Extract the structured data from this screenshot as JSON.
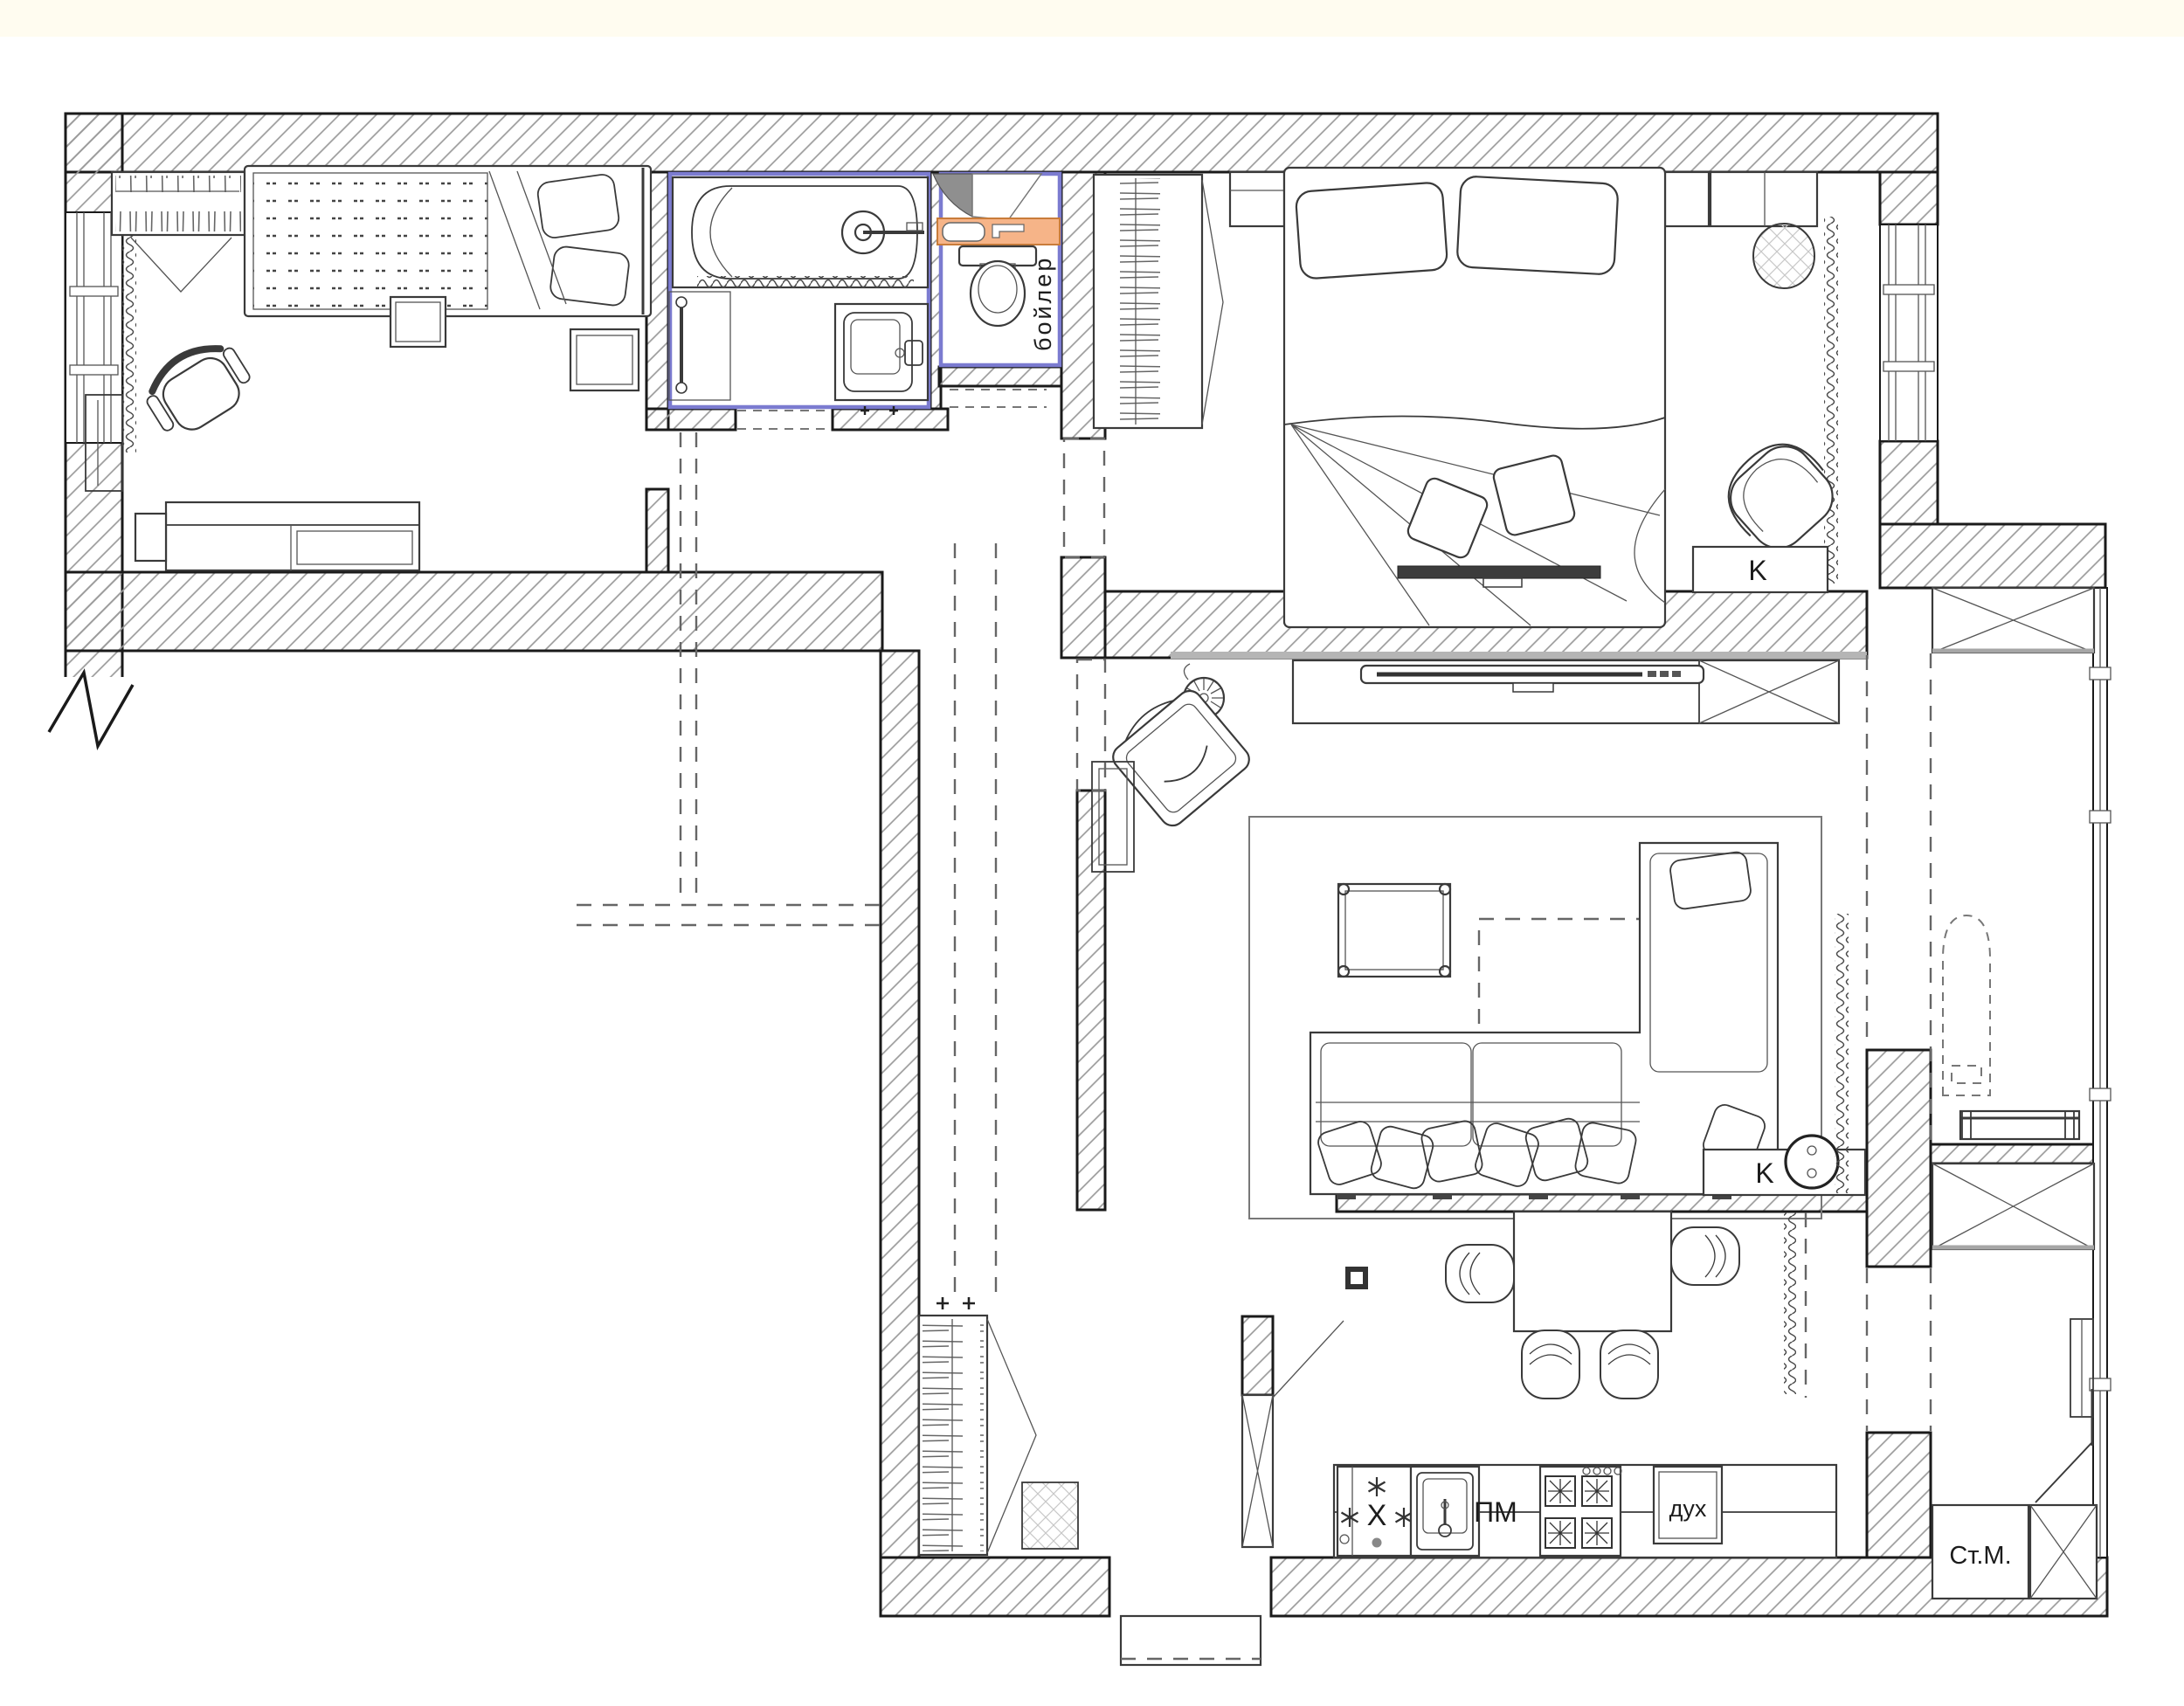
{
  "plan": {
    "kind": "apartment floor plan",
    "labels": {
      "boiler": "бойлер",
      "bedroom_chair_marker": "K",
      "vacuum_marker": "K",
      "dishwasher": "ПМ",
      "oven": "дух",
      "washing_machine": "Ст.М.",
      "fridge": "X"
    },
    "colors": {
      "wall_outline": "#1a1a1a",
      "wall_hatch": "#9a9a9a",
      "plumbing_accent": "#7b7bd0",
      "boiler_shelf_fill": "#f6b488",
      "vent_shaft_fill": "#8f8f8f",
      "top_paper_band": "#fffcf0"
    }
  }
}
